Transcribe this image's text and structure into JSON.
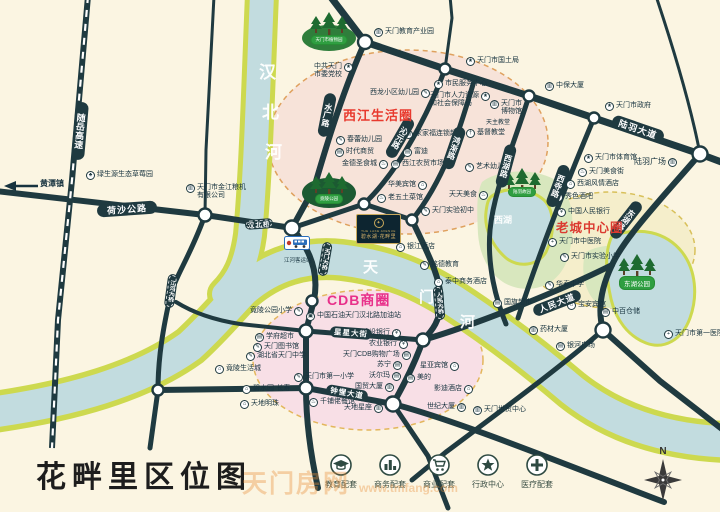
{
  "footer": {
    "title": "花畔里区位图",
    "watermark_cn": "天门房网",
    "watermark_en": "www.tmfang.com",
    "compass_n": "N",
    "legend": [
      {
        "icon": "education-icon",
        "label": "教育配套"
      },
      {
        "icon": "business-icon",
        "label": "商务配套"
      },
      {
        "icon": "shopping-icon",
        "label": "商业配套"
      },
      {
        "icon": "government-icon",
        "label": "行政中心"
      },
      {
        "icon": "medical-icon",
        "label": "医疗配套"
      }
    ]
  },
  "map": {
    "project": {
      "en": "THE LAKE AVENUE",
      "cn": "碧水湖·花畔里",
      "emblem": "✦"
    },
    "special": {
      "bus_station": "江河客运站",
      "arrow_label": "黄潭镇"
    },
    "icon_glyphs": {
      "edu": "✎",
      "gov": "★",
      "med": "+",
      "bank": "¥",
      "hotel": "⌂",
      "food": "♨",
      "shop": "▤",
      "biz": "▥",
      "home": "⌂",
      "farm": "♣",
      "gas": "▣",
      "church": "†"
    },
    "zone_labels": [
      {
        "t": "西江生活圈",
        "x": 343,
        "y": 105,
        "fs": 13,
        "c": "#E83A2E"
      },
      {
        "t": "CDB商圈",
        "x": 327,
        "y": 290,
        "fs": 14,
        "c": "#E8308A"
      },
      {
        "t": "老城中心圈",
        "x": 556,
        "y": 217,
        "fs": 12.5,
        "c": "#DB3A30"
      }
    ],
    "road_labels": [
      {
        "t": "荷沙公路",
        "cx": 127,
        "cy": 209,
        "w": 60,
        "h": 13,
        "r": -4,
        "fs": 9
      },
      {
        "t": "随岳高速",
        "cx": 80,
        "cy": 131,
        "w": 13,
        "h": 58,
        "r": 5,
        "fs": 9,
        "v": 1
      },
      {
        "t": "水厂路",
        "cx": 327,
        "cy": 115,
        "w": 12,
        "h": 44,
        "r": 11,
        "fs": 8,
        "v": 1
      },
      {
        "t": "沁元路",
        "cx": 400,
        "cy": 138,
        "w": 12,
        "h": 44,
        "r": 30,
        "fs": 8,
        "v": 1
      },
      {
        "t": "鸿渐路",
        "cx": 454,
        "cy": 148,
        "w": 12,
        "h": 44,
        "r": 19,
        "fs": 8,
        "v": 1
      },
      {
        "t": "西湖路",
        "cx": 506,
        "cy": 166,
        "w": 12,
        "h": 44,
        "r": 15,
        "fs": 8,
        "v": 1
      },
      {
        "t": "西寺路",
        "cx": 558,
        "cy": 186,
        "w": 12,
        "h": 44,
        "r": 20,
        "fs": 8,
        "v": 1
      },
      {
        "t": "东湖路",
        "cx": 626,
        "cy": 220,
        "w": 12,
        "h": 44,
        "r": 38,
        "fs": 8,
        "v": 1
      },
      {
        "t": "陆羽大道",
        "cx": 638,
        "cy": 129,
        "w": 54,
        "h": 13,
        "r": 19,
        "fs": 9
      },
      {
        "t": "人民大道",
        "cx": 557,
        "cy": 303,
        "w": 50,
        "h": 12,
        "r": -21,
        "fs": 8.5
      },
      {
        "t": "星星大街",
        "cx": 351,
        "cy": 333,
        "w": 42,
        "h": 11,
        "r": 4,
        "fs": 7.5
      },
      {
        "t": "钟惺大道",
        "cx": 347,
        "cy": 393,
        "w": 42,
        "h": 11,
        "r": 10,
        "fs": 7.5
      },
      {
        "t": "汉北桥",
        "cx": 259,
        "cy": 224,
        "w": 28,
        "h": 10,
        "r": -4,
        "fs": 6.5,
        "d": 1
      },
      {
        "t": "天门大桥",
        "cx": 325,
        "cy": 259,
        "w": 10,
        "h": 34,
        "r": 10,
        "fs": 5.5,
        "v": 1,
        "d": 1
      },
      {
        "t": "人民大桥",
        "cx": 439,
        "cy": 303,
        "w": 10,
        "h": 34,
        "r": -5,
        "fs": 5.5,
        "v": 1,
        "d": 1
      },
      {
        "t": "江河大桥",
        "cx": 171,
        "cy": 291,
        "w": 10,
        "h": 34,
        "r": 8,
        "fs": 5.5,
        "v": 1,
        "d": 1
      }
    ],
    "park_labels": [
      {
        "t": "天门市植物园",
        "cx": 329,
        "cy": 40,
        "fs": 4.5
      },
      {
        "t": "竟陵公园",
        "cx": 329,
        "cy": 199,
        "fs": 4.5
      },
      {
        "t": "陆羽故园",
        "cx": 522,
        "cy": 192,
        "fs": 4.5
      },
      {
        "t": "东湖公园",
        "cx": 637,
        "cy": 283,
        "fs": 6.5
      }
    ],
    "chars": [
      {
        "t": "汉",
        "x": 259,
        "y": 58,
        "fs": 17
      },
      {
        "t": "北",
        "x": 262,
        "y": 98,
        "fs": 17
      },
      {
        "t": "河",
        "x": 265,
        "y": 138,
        "fs": 17
      },
      {
        "t": "天",
        "x": 363,
        "y": 256,
        "fs": 15
      },
      {
        "t": "门",
        "x": 419,
        "y": 286,
        "fs": 15
      },
      {
        "t": "河",
        "x": 460,
        "y": 311,
        "fs": 15
      },
      {
        "t": "西湖",
        "x": 494,
        "y": 213,
        "fs": 9
      }
    ],
    "pois": [
      {
        "t": "绿生源生态草莓园",
        "x": 86,
        "y": 171,
        "i": "farm"
      },
      {
        "t": "天门市金江粮机有限公司",
        "x": 186,
        "y": 184,
        "i": "biz",
        "ln": [
          "天门市金江粮机",
          "有限公司"
        ]
      },
      {
        "t": "天门教育产业园",
        "x": 374,
        "y": 28,
        "i": "biz"
      },
      {
        "t": "中共天门市委党校",
        "x": 314,
        "y": 63,
        "i": "gov",
        "s": "r",
        "ln": [
          "中共天门",
          "市委党校"
        ]
      },
      {
        "t": "天门市国土局",
        "x": 466,
        "y": 57,
        "i": "gov"
      },
      {
        "t": "西龙小区幼儿园",
        "x": 370,
        "y": 89,
        "i": "edu",
        "s": "r"
      },
      {
        "t": "市民服务中心",
        "x": 434,
        "y": 80,
        "i": "gov"
      },
      {
        "t": "天门市人力资源和社会保障局",
        "x": 430,
        "y": 92,
        "i": "gov",
        "s": "r",
        "ln": [
          "天门市人力资源",
          "和社会保障局"
        ]
      },
      {
        "t": "中保大厦",
        "x": 545,
        "y": 82,
        "i": "biz"
      },
      {
        "t": "天门市政府",
        "x": 605,
        "y": 102,
        "i": "gov"
      },
      {
        "t": "天门市博物馆",
        "x": 490,
        "y": 100,
        "i": "biz",
        "ln": [
          "天门市",
          "博物馆"
        ]
      },
      {
        "t": "天主教堂",
        "x": 486,
        "y": 119,
        "fs": 6
      },
      {
        "t": "基督教堂",
        "x": 466,
        "y": 129,
        "i": "church"
      },
      {
        "t": "春蕾幼儿园",
        "x": 336,
        "y": 136,
        "i": "edu"
      },
      {
        "t": "时代商贸",
        "x": 335,
        "y": 148,
        "i": "shop"
      },
      {
        "t": "金德圣食城",
        "x": 342,
        "y": 160,
        "i": "food",
        "s": "r"
      },
      {
        "t": "家家福连锁超市",
        "x": 404,
        "y": 130,
        "i": "shop"
      },
      {
        "t": "富迪",
        "x": 403,
        "y": 148,
        "i": "shop"
      },
      {
        "t": "西江农贸市场",
        "x": 391,
        "y": 160,
        "i": "shop"
      },
      {
        "t": "华美宾馆",
        "x": 388,
        "y": 181,
        "i": "hotel",
        "s": "r"
      },
      {
        "t": "老五土菜馆",
        "x": 377,
        "y": 194,
        "i": "food"
      },
      {
        "t": "天天美食",
        "x": 449,
        "y": 191,
        "i": "food",
        "s": "r"
      },
      {
        "t": "天门实验初中",
        "x": 421,
        "y": 207,
        "i": "edu"
      },
      {
        "t": "银江酒店",
        "x": 396,
        "y": 243,
        "i": "hotel"
      },
      {
        "t": "铭德教育",
        "x": 420,
        "y": 261,
        "i": "edu"
      },
      {
        "t": "泰中商务酒店",
        "x": 434,
        "y": 278,
        "i": "hotel"
      },
      {
        "t": "艺术幼儿园",
        "x": 465,
        "y": 163,
        "i": "edu"
      },
      {
        "t": "陆羽广场",
        "x": 634,
        "y": 158,
        "i": "biz",
        "s": "r",
        "fs": 8
      },
      {
        "t": "天门市体育馆",
        "x": 584,
        "y": 154,
        "i": "gov"
      },
      {
        "t": "天门美食街",
        "x": 578,
        "y": 168,
        "i": "food"
      },
      {
        "t": "西湖风情酒店",
        "x": 566,
        "y": 180,
        "i": "hotel"
      },
      {
        "t": "秀色酒吧",
        "x": 554,
        "y": 193,
        "i": "food"
      },
      {
        "t": "中国人民银行",
        "x": 557,
        "y": 208,
        "i": "bank"
      },
      {
        "t": "天门市中医院",
        "x": 548,
        "y": 238,
        "i": "med"
      },
      {
        "t": "天门市实验小学",
        "x": 560,
        "y": 253,
        "i": "edu"
      },
      {
        "t": "华泰中学",
        "x": 545,
        "y": 281,
        "i": "edu"
      },
      {
        "t": "宝安宾馆",
        "x": 567,
        "y": 301,
        "i": "hotel"
      },
      {
        "t": "中百仓储",
        "x": 601,
        "y": 308,
        "i": "shop"
      },
      {
        "t": "天门市第一医院",
        "x": 664,
        "y": 330,
        "i": "med"
      },
      {
        "t": "银河广场",
        "x": 556,
        "y": 342,
        "i": "shop"
      },
      {
        "t": "国旗超市",
        "x": 493,
        "y": 299,
        "i": "shop"
      },
      {
        "t": "药材大厦",
        "x": 529,
        "y": 326,
        "i": "biz"
      },
      {
        "t": "星亚宾馆",
        "x": 420,
        "y": 362,
        "i": "hotel",
        "s": "r"
      },
      {
        "t": "美的",
        "x": 406,
        "y": 374,
        "i": "shop"
      },
      {
        "t": "影迪酒店",
        "x": 434,
        "y": 385,
        "i": "hotel",
        "s": "r"
      },
      {
        "t": "世纪大厦",
        "x": 427,
        "y": 403,
        "i": "biz",
        "s": "r"
      },
      {
        "t": "天门世贸中心",
        "x": 473,
        "y": 406,
        "i": "biz"
      },
      {
        "t": "建设银行",
        "x": 362,
        "y": 329,
        "i": "bank",
        "s": "r"
      },
      {
        "t": "农业银行",
        "x": 369,
        "y": 340,
        "i": "bank",
        "s": "r"
      },
      {
        "t": "天门CDB购物广场",
        "x": 343,
        "y": 351,
        "i": "shop",
        "s": "r"
      },
      {
        "t": "苏宁",
        "x": 377,
        "y": 361,
        "i": "shop",
        "s": "r"
      },
      {
        "t": "沃尔玛",
        "x": 369,
        "y": 372,
        "i": "shop",
        "s": "r"
      },
      {
        "t": "国贸大厦",
        "x": 355,
        "y": 383,
        "i": "biz",
        "s": "r"
      },
      {
        "t": "天地星座",
        "x": 344,
        "y": 404,
        "i": "biz",
        "s": "r"
      },
      {
        "t": "千铺佬餐馆",
        "x": 309,
        "y": 398,
        "i": "food"
      },
      {
        "t": "天门市第一小学",
        "x": 294,
        "y": 373,
        "i": "edu"
      },
      {
        "t": "湖北省天门中学",
        "x": 246,
        "y": 352,
        "i": "edu"
      },
      {
        "t": "天门图书馆",
        "x": 253,
        "y": 343,
        "i": "edu"
      },
      {
        "t": "学府超市",
        "x": 255,
        "y": 333,
        "i": "shop"
      },
      {
        "t": "竟陵公园小学",
        "x": 250,
        "y": 307,
        "i": "edu",
        "s": "r"
      },
      {
        "t": "中国石油天门汉北路加油站",
        "x": 306,
        "y": 312,
        "i": "gas"
      },
      {
        "t": "碧水园·长寿",
        "x": 242,
        "y": 385,
        "i": "home"
      },
      {
        "t": "天地明珠",
        "x": 240,
        "y": 400,
        "i": "home"
      },
      {
        "t": "竟陵生活城",
        "x": 215,
        "y": 365,
        "i": "home"
      }
    ]
  }
}
